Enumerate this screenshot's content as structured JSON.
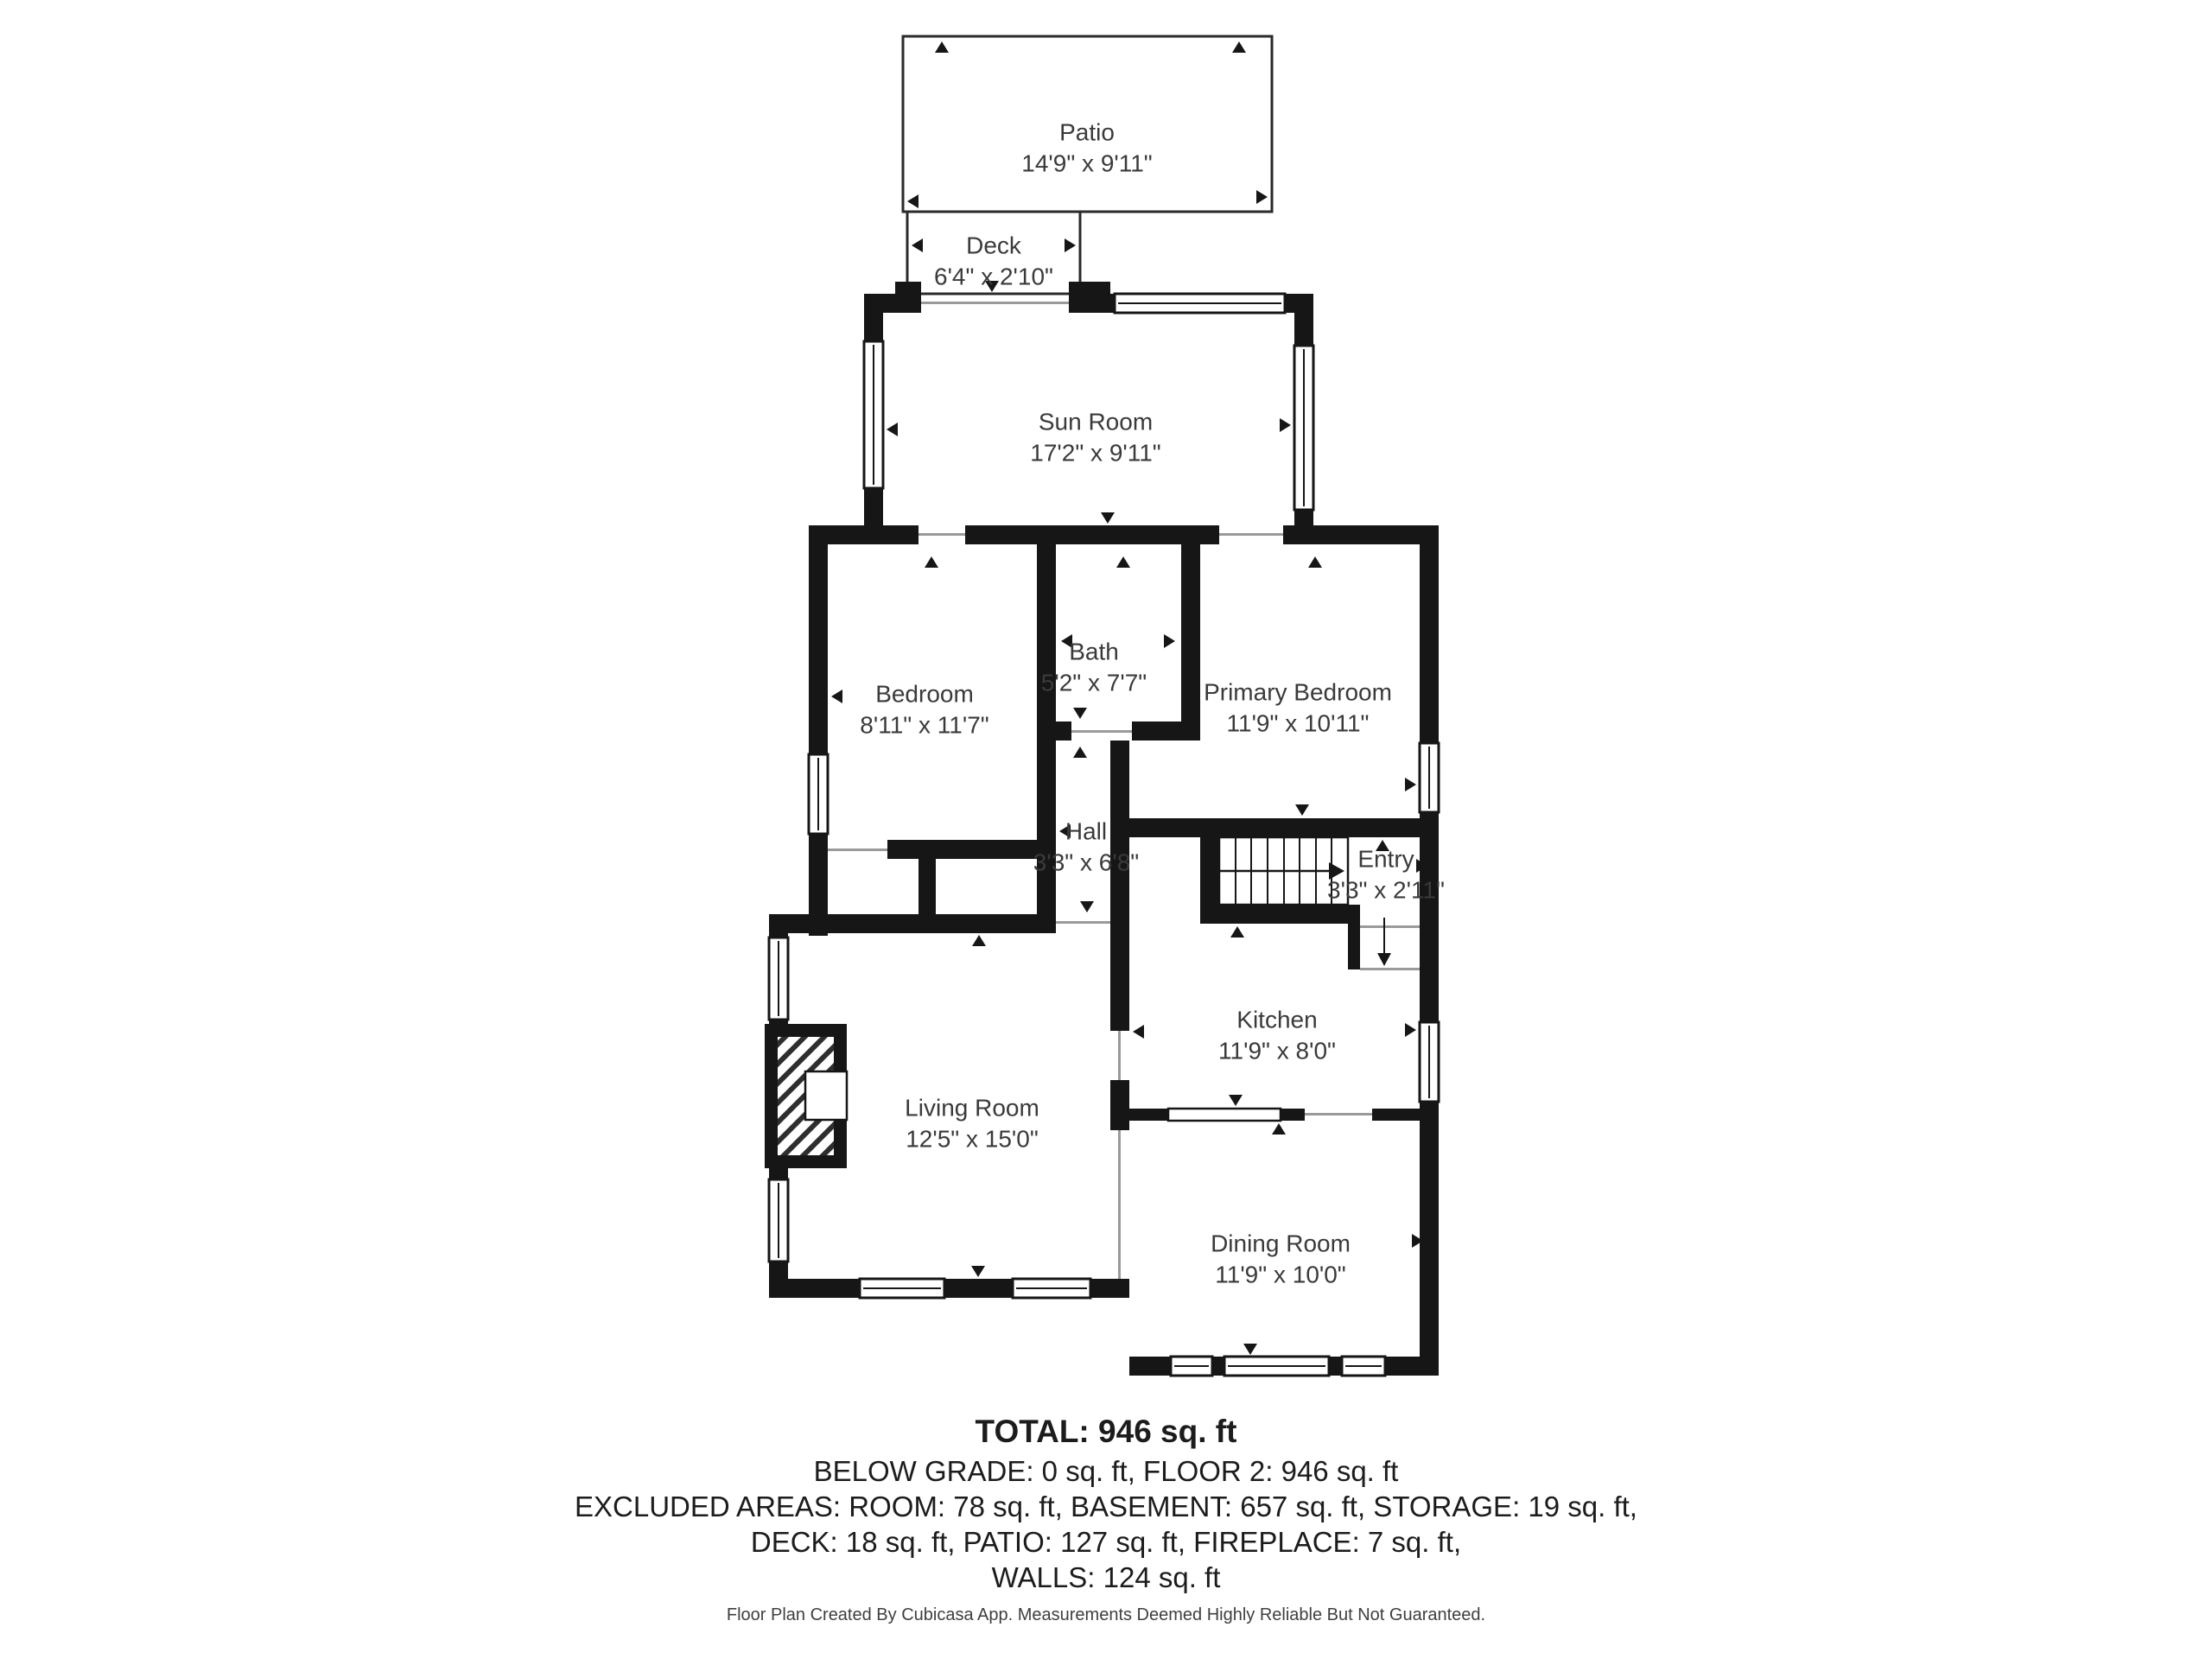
{
  "rooms": {
    "patio": {
      "name": "Patio",
      "dims": "14'9\" x 9'11\""
    },
    "deck": {
      "name": "Deck",
      "dims": "6'4\" x 2'10\""
    },
    "sun_room": {
      "name": "Sun Room",
      "dims": "17'2\" x 9'11\""
    },
    "bath": {
      "name": "Bath",
      "dims": "5'2\" x 7'7\""
    },
    "bedroom": {
      "name": "Bedroom",
      "dims": "8'11\" x 11'7\""
    },
    "primary_bedroom": {
      "name": "Primary Bedroom",
      "dims": "11'9\" x 10'11\""
    },
    "hall": {
      "name": "Hall",
      "dims": "3'3\" x 6'8\""
    },
    "entry": {
      "name": "Entry",
      "dims": "3'3\" x 2'11\""
    },
    "kitchen": {
      "name": "Kitchen",
      "dims": "11'9\" x 8'0\""
    },
    "living_room": {
      "name": "Living Room",
      "dims": "12'5\" x 15'0\""
    },
    "dining_room": {
      "name": "Dining Room",
      "dims": "11'9\" x 10'0\""
    }
  },
  "summary": {
    "total": "TOTAL: 946 sq. ft",
    "below_grade_floor2": "BELOW GRADE: 0 sq. ft, FLOOR 2: 946 sq. ft",
    "excluded_1": "EXCLUDED AREAS: ROOM: 78 sq. ft, BASEMENT: 657 sq. ft, STORAGE: 19 sq. ft,",
    "excluded_2": "DECK: 18 sq. ft, PATIO: 127 sq. ft, FIREPLACE: 7 sq. ft,",
    "walls": "WALLS: 124 sq. ft"
  },
  "footer": "Floor Plan Created By Cubicasa App. Measurements Deemed Highly Reliable But Not Guaranteed.",
  "colors": {
    "wall": "#161616",
    "opening_line": "#9a9a9a",
    "text": "#3a3a3a",
    "background": "#ffffff"
  }
}
